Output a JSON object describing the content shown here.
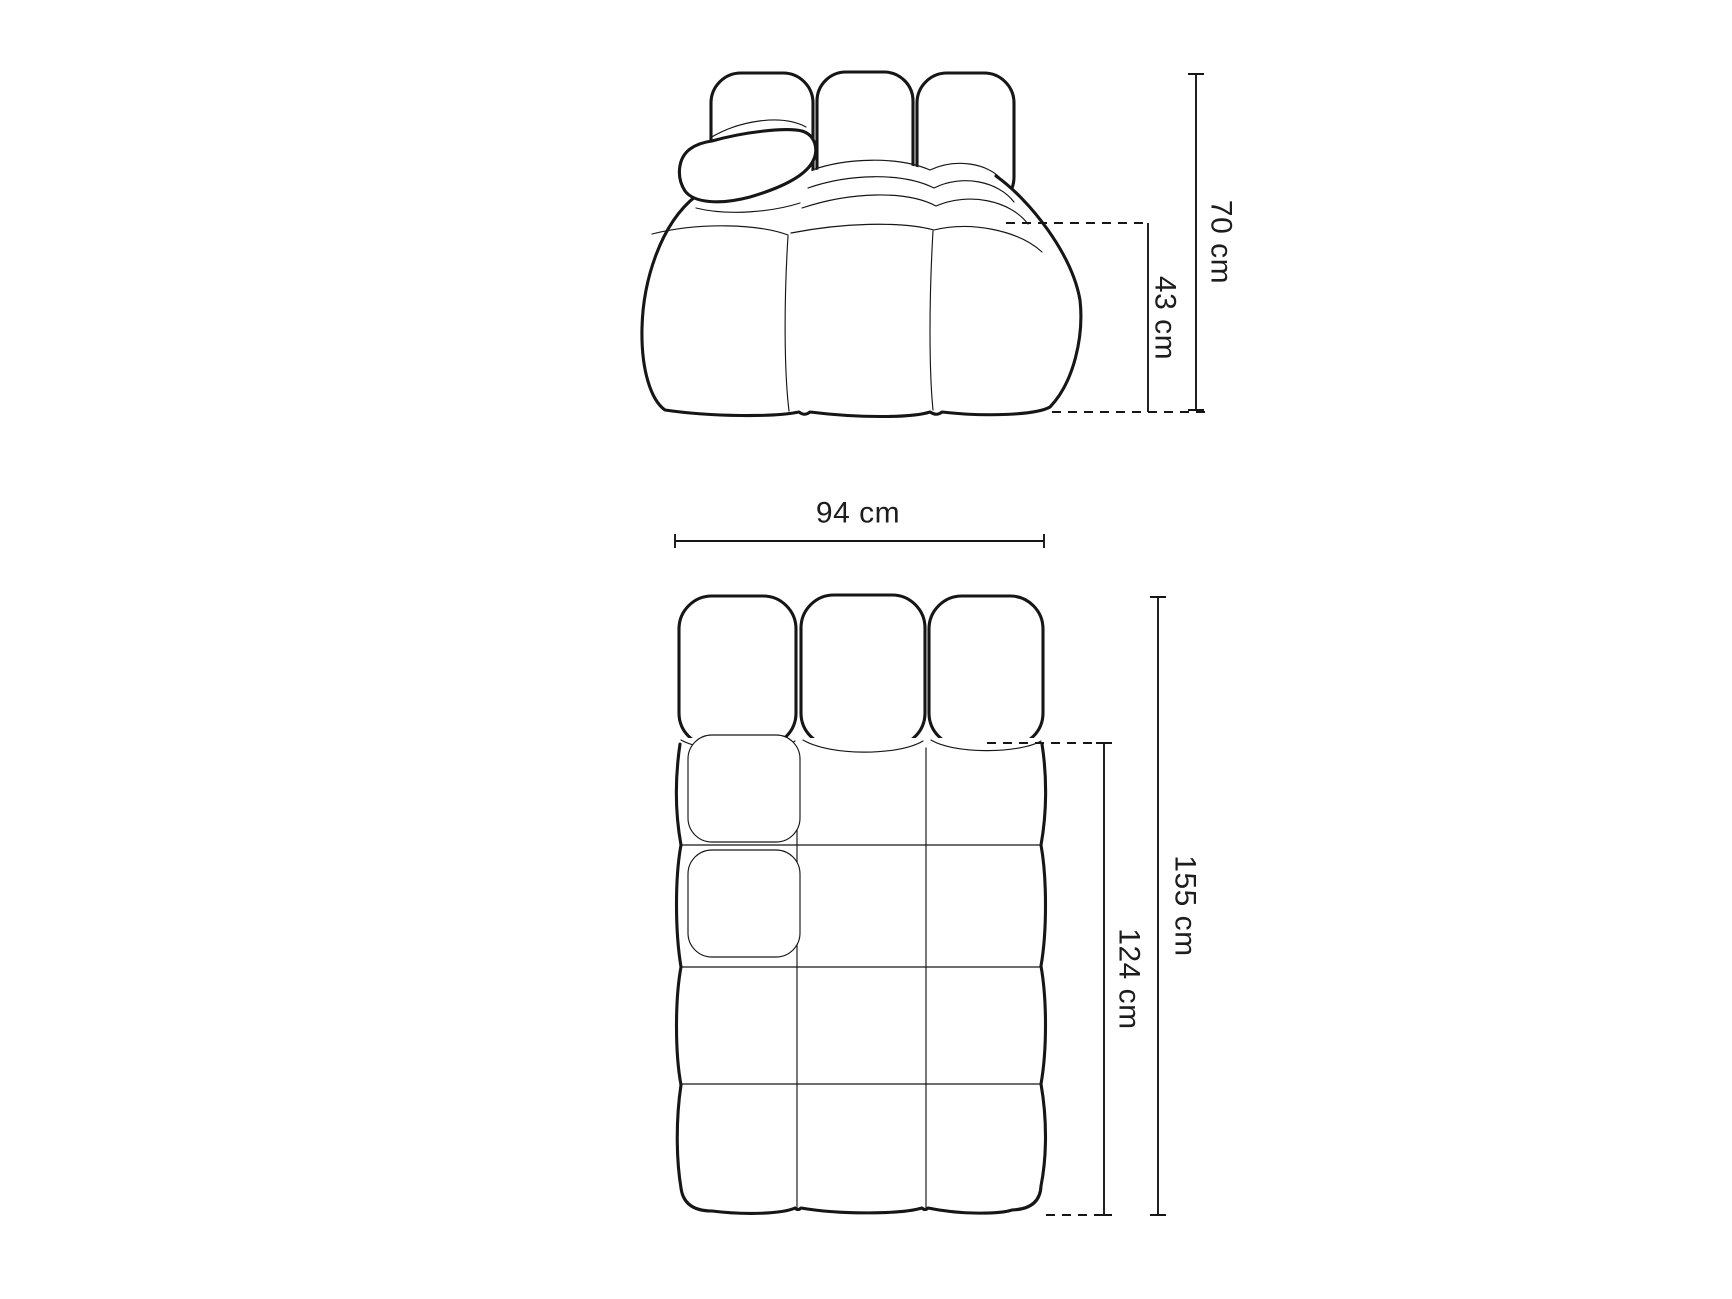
{
  "colors": {
    "background": "#ffffff",
    "line": "#161616",
    "text": "#1d1d1d"
  },
  "diagram": {
    "front_view": {
      "dimensions": {
        "total_height": "70 cm",
        "seat_height": "43 cm"
      }
    },
    "top_view": {
      "dimensions": {
        "width": "94 cm",
        "total_depth": "155 cm",
        "seat_depth": "124 cm"
      }
    }
  }
}
